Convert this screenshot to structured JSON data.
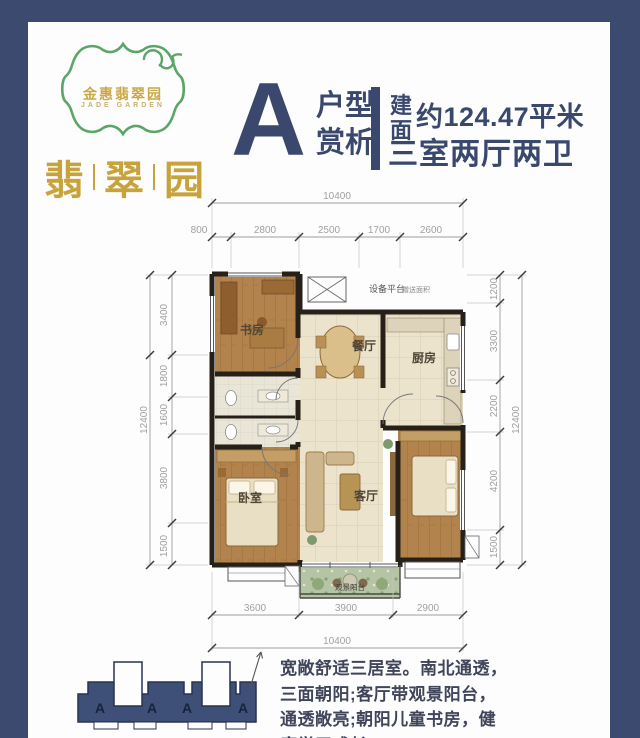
{
  "colors": {
    "navy": "#3b4a6e",
    "gold": "#c8a33b",
    "green": "#5ba667"
  },
  "logo": {
    "name_cn": "金惠翡翠园",
    "name_en": "JADE GARDEN"
  },
  "brand": {
    "char1": "翡",
    "char2": "翠",
    "char3": "园"
  },
  "header": {
    "letter": "A",
    "type_top": "户型",
    "type_bottom": "赏析",
    "area_char_top": "建",
    "area_char_bottom": "面",
    "area_text": "约124.47平米",
    "rooms_text": "三室两厅两卫"
  },
  "plan": {
    "rooms": {
      "study": "书房",
      "dining": "餐厅",
      "kitchen": "厨房",
      "bedroom": "卧室",
      "living": "客厅"
    },
    "equipment": "设备平台",
    "equipment_note": "赠送面积",
    "balcony": "观景阳台",
    "dims": {
      "top_total": "10400",
      "top": [
        "800",
        "2800",
        "2500",
        "1700",
        "2600"
      ],
      "left_total": "12400",
      "left": [
        "3400",
        "1800",
        "1600",
        "3800",
        "1500"
      ],
      "right_total": "12400",
      "right": [
        "1200",
        "3300",
        "2200",
        "4200",
        "1500"
      ],
      "bottom_total": "10400",
      "bottom": [
        "3600",
        "3900",
        "2900"
      ]
    }
  },
  "footprint": {
    "units": [
      "A",
      "A",
      "A",
      "A"
    ]
  },
  "description": {
    "line1": "宽敞舒适三居室。南北通透，",
    "line2": "三面朝阳;客厅带观景阳台，",
    "line3": "通透敞亮;朝阳儿童书房，健",
    "line4": "康学习成长。"
  }
}
